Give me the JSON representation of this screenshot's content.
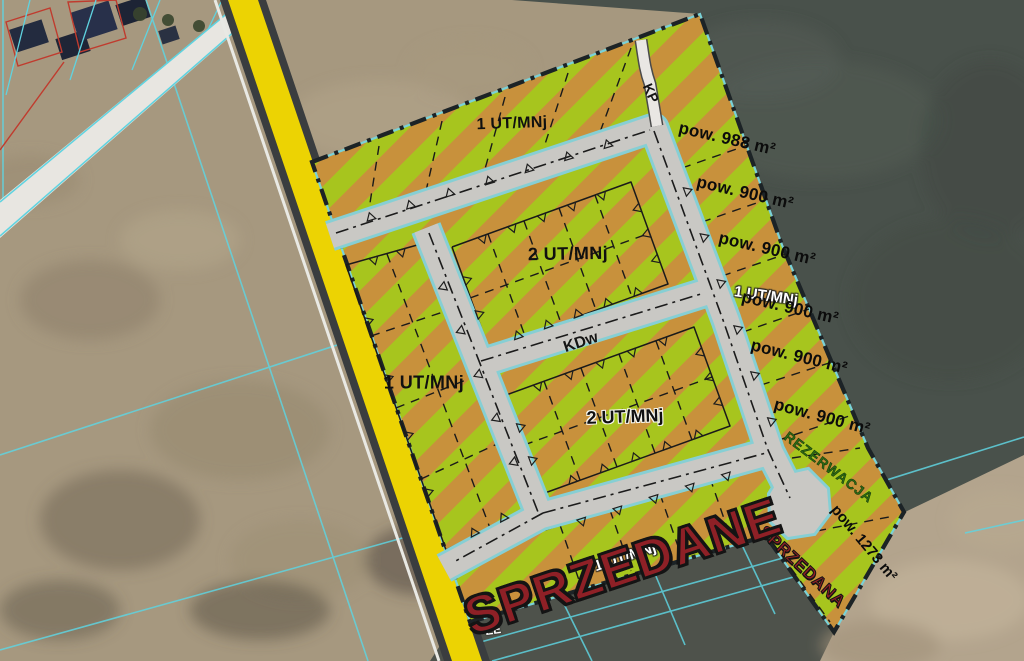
{
  "title": "Land subdivision sale plan over aerial photo",
  "colors": {
    "stripe_green": "#a7c51e",
    "stripe_orange": "#c8913c",
    "road_fill": "#c9c8c4",
    "road_edge_cyan": "#86cfd4",
    "boundary_dark": "#1c2326",
    "highway_yellow": "#ecd303",
    "parcel_line_cyan": "#5fd3e0",
    "sold_red": "#8e2026",
    "reserved_green": "#2e6b14",
    "white_road": "#e8e6e1"
  },
  "labels": [
    {
      "name": "zone-top",
      "text": "1 UT/MNj"
    },
    {
      "name": "path-kp",
      "text": "KP"
    },
    {
      "name": "area-988",
      "text": "pow. 988 m²"
    },
    {
      "name": "area-900-1",
      "text": "pow. 900 m²"
    },
    {
      "name": "area-900-2",
      "text": "pow. 900 m²"
    },
    {
      "name": "zone-right",
      "text": "1 UT/MNj"
    },
    {
      "name": "area-900-3",
      "text": "pow. 900 m²"
    },
    {
      "name": "area-900-4",
      "text": "pow. 900 m²"
    },
    {
      "name": "area-900-5",
      "text": "pow. 900 m²"
    },
    {
      "name": "zone-upper",
      "text": "2 UT/MNj"
    },
    {
      "name": "road-kdw",
      "text": "KDw"
    },
    {
      "name": "zone-left",
      "text": "1 UT/MNj"
    },
    {
      "name": "zone-lower",
      "text": "2 UT/MNj"
    },
    {
      "name": "zone-bottom-hidden",
      "text": "1 UT/MNj"
    },
    {
      "name": "status-sold-banner",
      "text": "SPRZEDANE"
    },
    {
      "name": "status-sold-parcel",
      "text": "SPRZEDANA"
    },
    {
      "name": "area-1273",
      "text": "pow. 1273 m²"
    },
    {
      "name": "status-reserved",
      "text": "REZERWACJA"
    },
    {
      "name": "marker-ee",
      "text": "EE"
    }
  ]
}
